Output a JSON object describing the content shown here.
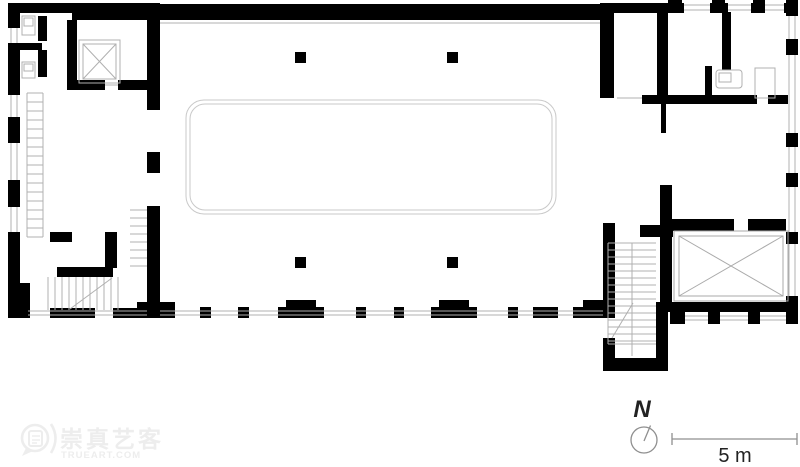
{
  "plan": {
    "type": "architectural-floor-plan",
    "north_label": "N",
    "scale_label": "5 m"
  },
  "watermark": {
    "cn": "崇真艺客",
    "en": "TRUEART.COM"
  },
  "colors": {
    "bg": "#ffffff",
    "wall": "#000000",
    "thin-line": "#b0b0b0",
    "skylight-line": "#c9c9c9",
    "void-line": "#aaaaaa",
    "annotation": "#8f8f8f",
    "text": "#222222",
    "watermark": "#ededed"
  }
}
